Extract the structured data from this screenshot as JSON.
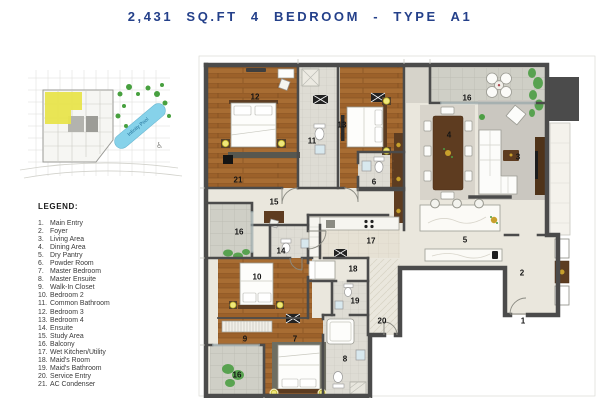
{
  "title": "2,431 SQ.FT 4 BEDROOM - TYPE A1",
  "key_plan": {
    "pool_label": "Infinity Pool",
    "icon_accessibility": "♿"
  },
  "legend": {
    "heading": "LEGEND:",
    "items": [
      {
        "num": "1.",
        "label": "Main Entry"
      },
      {
        "num": "2.",
        "label": "Foyer"
      },
      {
        "num": "3.",
        "label": "Living Area"
      },
      {
        "num": "4.",
        "label": "Dining Area"
      },
      {
        "num": "5.",
        "label": "Dry Pantry"
      },
      {
        "num": "6.",
        "label": "Powder Room"
      },
      {
        "num": "7.",
        "label": "Master Bedroom"
      },
      {
        "num": "8.",
        "label": "Master Ensuite"
      },
      {
        "num": "9.",
        "label": "Walk-In Closet"
      },
      {
        "num": "10.",
        "label": "Bedroom 2"
      },
      {
        "num": "11.",
        "label": "Common Bathroom"
      },
      {
        "num": "12.",
        "label": "Bedroom 3"
      },
      {
        "num": "13.",
        "label": "Bedroom 4"
      },
      {
        "num": "14.",
        "label": "Ensuite"
      },
      {
        "num": "15.",
        "label": "Study Area"
      },
      {
        "num": "16.",
        "label": "Balcony"
      },
      {
        "num": "17.",
        "label": "Wet Kitchen/Utility"
      },
      {
        "num": "18.",
        "label": "Maid's Room"
      },
      {
        "num": "19.",
        "label": "Maid's Bathroom"
      },
      {
        "num": "20.",
        "label": "Service Entry"
      },
      {
        "num": "21.",
        "label": "AC Condenser"
      }
    ]
  },
  "plan": {
    "room_labels": [
      {
        "text": "12",
        "x": 57,
        "y": 44
      },
      {
        "text": "11",
        "x": 114,
        "y": 88
      },
      {
        "text": "13",
        "x": 144,
        "y": 72
      },
      {
        "text": "6",
        "x": 176,
        "y": 129
      },
      {
        "text": "21",
        "x": 40,
        "y": 127
      },
      {
        "text": "16",
        "x": 269,
        "y": 45
      },
      {
        "text": "4",
        "x": 251,
        "y": 82
      },
      {
        "text": "3",
        "x": 320,
        "y": 104
      },
      {
        "text": "5",
        "x": 267,
        "y": 187
      },
      {
        "text": "15",
        "x": 76,
        "y": 149
      },
      {
        "text": "14",
        "x": 83,
        "y": 198
      },
      {
        "text": "16",
        "x": 41,
        "y": 179
      },
      {
        "text": "10",
        "x": 59,
        "y": 224
      },
      {
        "text": "17",
        "x": 173,
        "y": 188
      },
      {
        "text": "18",
        "x": 155,
        "y": 216
      },
      {
        "text": "19",
        "x": 157,
        "y": 248
      },
      {
        "text": "20",
        "x": 184,
        "y": 268
      },
      {
        "text": "9",
        "x": 47,
        "y": 286
      },
      {
        "text": "7",
        "x": 97,
        "y": 286
      },
      {
        "text": "8",
        "x": 147,
        "y": 306
      },
      {
        "text": "16",
        "x": 39,
        "y": 322
      },
      {
        "text": "2",
        "x": 324,
        "y": 220
      },
      {
        "text": "1",
        "x": 325,
        "y": 268
      }
    ]
  },
  "colors": {
    "title_navy": "#24408a",
    "wall_gray": "#4b4b4b",
    "wood_floor": "#a2672e",
    "balcony_tile": "#cfcfc6",
    "cream_floor": "#eae7dd",
    "pool_blue": "#86d2ea",
    "unit_highlight_yellow": "#e8e44c",
    "tree_green": "#47a03f",
    "accent_gold": "#c8a02c"
  }
}
